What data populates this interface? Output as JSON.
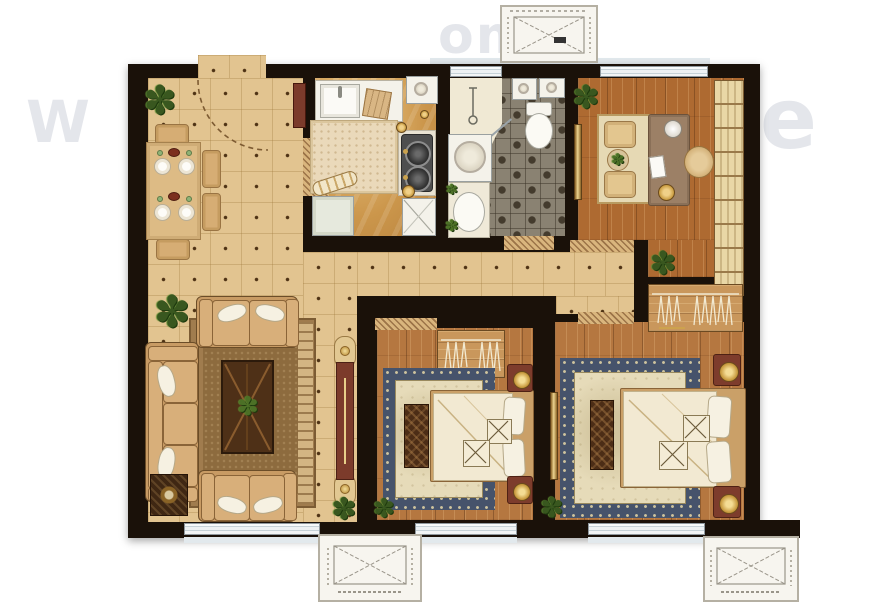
{
  "meta": {
    "description": "Top-down rendered residential floor plan: entry/dining, kitchen, bathroom, study, hallway, living room, second bedroom, master bedroom, three exterior AC platforms"
  },
  "icons": {
    "plant": "✽"
  },
  "watermark": {
    "letters": [
      {
        "t": "W"
      },
      {
        "t": "om"
      },
      {
        "t": "e"
      },
      {
        "t": "e"
      }
    ]
  },
  "palette": {
    "wall": "#1a1109",
    "tile_floor": "#e2c490",
    "wood_room": "#ae6a31",
    "wood_bedroom": "#b57740",
    "wood_closet": "#c9975c",
    "kitchen_marble": "#d3a055",
    "bath_checker": "#8a8272",
    "rug_border_blue": "#46536b",
    "rug_field_cream": "#e6dbb9",
    "living_rug_brown": "#a07c4e",
    "sofa_tan": "#c89b64",
    "accent_maroon": "#7c3b2b",
    "accent_gold": "#cda24e",
    "fixture_white": "#f4f2ea",
    "window_glass": "#dce4e9"
  },
  "rooms": [
    {
      "name": "dining area"
    },
    {
      "name": "kitchen"
    },
    {
      "name": "bathroom"
    },
    {
      "name": "study"
    },
    {
      "name": "hallway"
    },
    {
      "name": "living room"
    },
    {
      "name": "second bedroom"
    },
    {
      "name": "master bedroom"
    },
    {
      "name": "ac platform top"
    },
    {
      "name": "ac platform bottom left"
    },
    {
      "name": "ac platform bottom right"
    }
  ]
}
